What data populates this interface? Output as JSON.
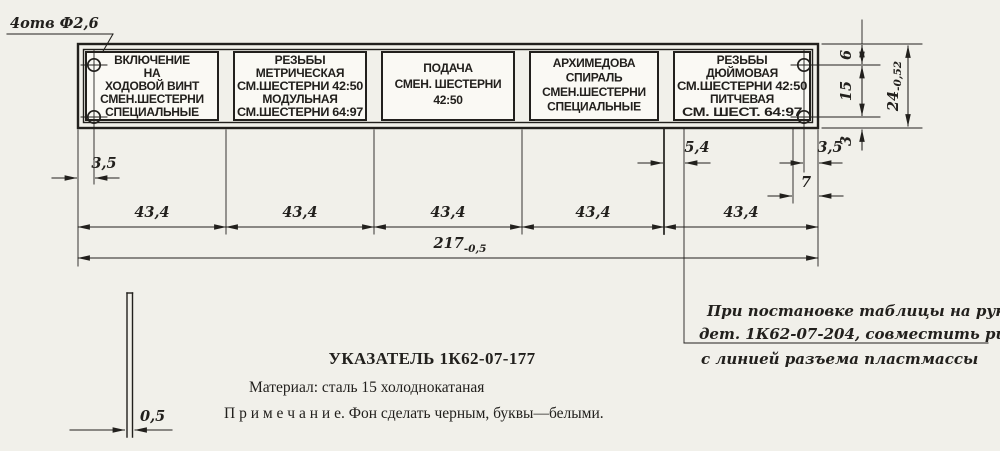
{
  "meta": {
    "paper": "#f1f0ea",
    "ink": "#22201d"
  },
  "callout": {
    "holes": "4отв Ф2,6"
  },
  "plate": {
    "panels": [
      {
        "lines": [
          "ВКЛЮЧЕНИЕ",
          "НА",
          "ХОДОВОЙ ВИНТ",
          "СМЕН.ШЕСТЕРНИ",
          "СПЕЦИАЛЬНЫЕ"
        ]
      },
      {
        "lines": [
          "РЕЗЬБЫ",
          "МЕТРИЧЕСКАЯ",
          "СМ.ШЕСТЕРНИ 42:50",
          "МОДУЛЬНАЯ",
          "СМ.ШЕСТЕРНИ 64:97"
        ]
      },
      {
        "lines": [
          "ПОДАЧА",
          "СМЕН. ШЕСТЕРНИ",
          "42:50"
        ]
      },
      {
        "lines": [
          "АРХИМЕДОВА",
          "СПИРАЛЬ",
          "СМЕН.ШЕСТЕРНИ",
          "СПЕЦИАЛЬНЫЕ"
        ]
      },
      {
        "lines": [
          "РЕЗЬБЫ",
          "ДЮЙМОВАЯ",
          "СМ.ШЕСТЕРНИ 42:50",
          "ПИТЧЕВАЯ",
          "СМ. ШЕСТ. 64:97"
        ]
      }
    ]
  },
  "dims": {
    "segments": [
      "43,4",
      "43,4",
      "43,4",
      "43,4",
      "43,4"
    ],
    "total_width": "217",
    "total_width_tol": "-0,5",
    "left_edge_to_hole": "3,5",
    "riska_to_panel": "5,4",
    "hole_to_edge_right": "3,5",
    "hole_pitch_right": "7",
    "top_to_hole": "6",
    "hole_to_hole": "15",
    "hole_to_bottom": "3",
    "total_height": "24",
    "total_height_tol": "-0,52",
    "thickness": "0,5"
  },
  "footer": {
    "title": "УКАЗАТЕЛЬ 1К62-07-177",
    "material": "Материал: сталь 15  холоднокатаная",
    "note": "П р и м е ч а н и е.  Фон сделать черным, буквы—белыми."
  },
  "side_note": {
    "lines": [
      "При постановке таблицы на рукоятку",
      "дет. 1К62-07-204, совместить риску",
      "с линией разъема пластмассы"
    ]
  }
}
